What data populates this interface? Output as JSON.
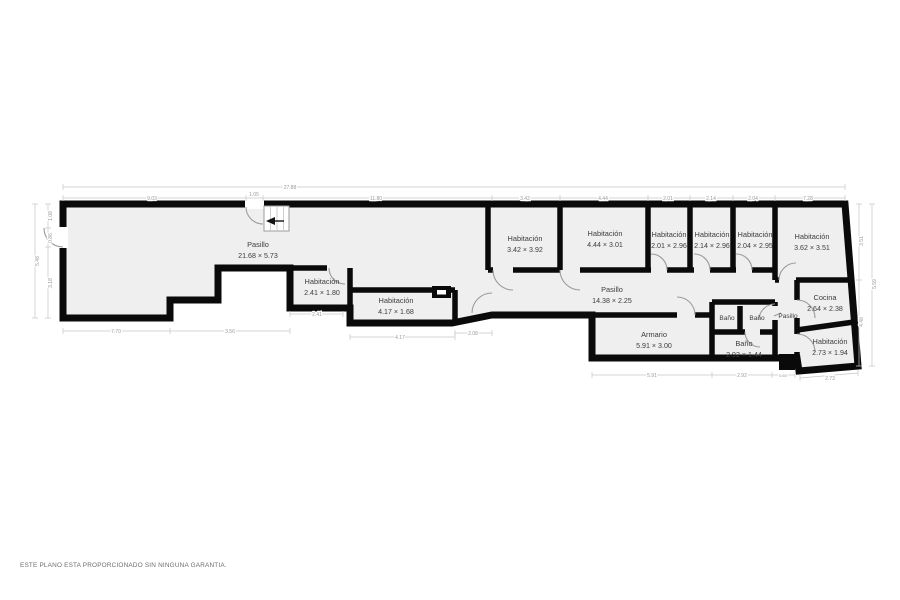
{
  "page": {
    "disclaimer": "ESTE PLANO ESTA PROPORCIONADO SIN NINGUNA GARANTIA."
  },
  "floorplan": {
    "colors": {
      "floor": "#efefef",
      "walls": "#0a0a0a",
      "dim_lines": "#c6c6c6",
      "dim_text": "#9a9a9a",
      "room_text": "#3d3d3d"
    },
    "rooms": [
      {
        "name": "Pasillo",
        "dims": "21.68 × 5.73"
      },
      {
        "name": "Habitación",
        "dims": "2.41 × 1.80"
      },
      {
        "name": "Habitación",
        "dims": "4.17 × 1.68"
      },
      {
        "name": "Habitación",
        "dims": "3.42 × 3.92"
      },
      {
        "name": "Habitación",
        "dims": "4.44 × 3.01"
      },
      {
        "name": "Habitación",
        "dims": "2.01 × 2.96"
      },
      {
        "name": "Habitación",
        "dims": "2.14 × 2.96"
      },
      {
        "name": "Habitación",
        "dims": "2.04 × 2.95"
      },
      {
        "name": "Habitación",
        "dims": "3.62 × 3.51"
      },
      {
        "name": "Pasillo",
        "dims": "14.38 × 2.25"
      },
      {
        "name": "Armario",
        "dims": "5.91 × 3.00"
      },
      {
        "name": "Baño"
      },
      {
        "name": "Baño"
      },
      {
        "name": "Pasillo"
      },
      {
        "name": "Baño",
        "dims": "2.92 × 1.44"
      },
      {
        "name": "Cocina",
        "dims": "2.64 × 2.38"
      },
      {
        "name": "Habitación",
        "dims": "2.73 × 1.94"
      }
    ],
    "dim_labels": [
      "27.88",
      "9.03",
      "1.05",
      "11.80",
      "3.42",
      "4.44",
      "2.01",
      "2.14",
      "2.04",
      "7.28",
      "5.48",
      "1.08",
      "0.86",
      "3.18",
      "7.70",
      "3.56",
      "2.41",
      "4.17",
      "2.08",
      "5.91",
      "2.92",
      "0.60",
      "2.73",
      "5.59",
      "3.51",
      "4.48"
    ]
  }
}
